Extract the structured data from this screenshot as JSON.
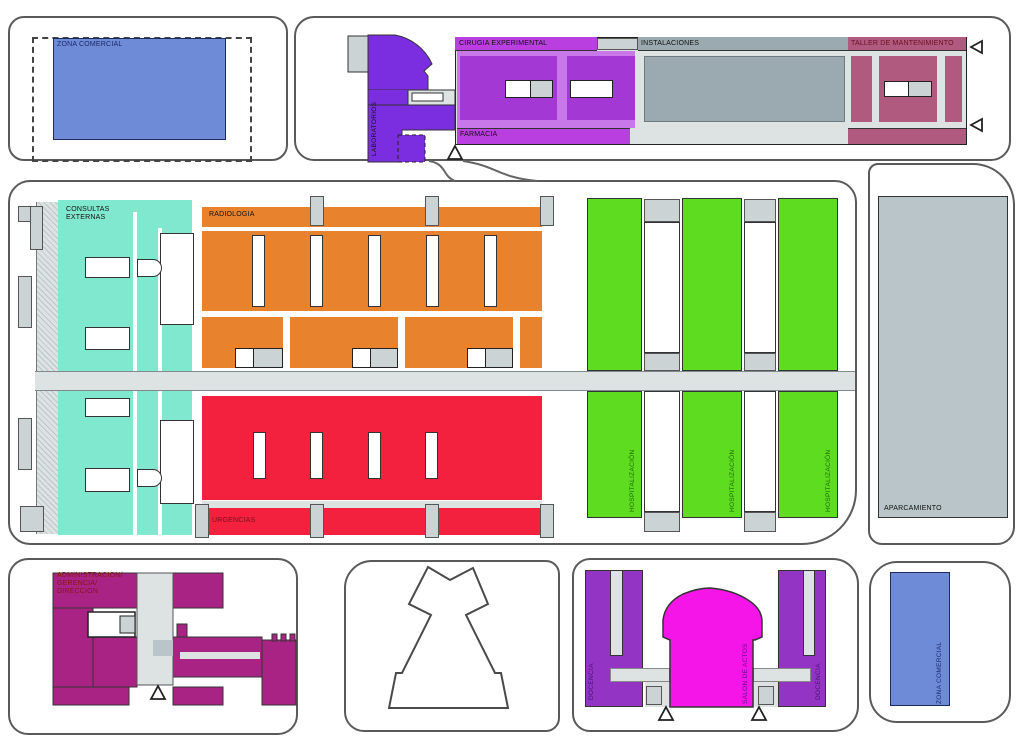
{
  "diagram": {
    "title": "hospital-zoning-floor-plan",
    "palette": {
      "blue": "#6e8bd8",
      "violet": "#7b2ee0",
      "bright_purple": "#b93fe0",
      "light_purple": "#c878e8",
      "dark_purple": "#a438d4",
      "gray_block": "#9baab0",
      "mauve": "#b05a80",
      "teal": "#80e8cf",
      "orange": "#e8822c",
      "red": "#f3203e",
      "green": "#5edc1f",
      "admin_magenta": "#a82384",
      "docencia_purple": "#9434c4",
      "salon_magenta": "#f515e8",
      "parking_gray": "#b9c5c8",
      "corridor_gray": "#dde2e2"
    },
    "zones": {
      "zona_comercial_top": {
        "label": "ZONA COMERCIAL",
        "color": "#6e8bd8"
      },
      "laboratorios": {
        "label": "LABORATORIOS",
        "color": "#7b2ee0"
      },
      "cirugia_experimental": {
        "label": "CIRUGIA EXPERIMENTAL",
        "color": "#b93fe0"
      },
      "farmacia": {
        "label": "FARMACIA",
        "color": "#b93fe0"
      },
      "instalaciones": {
        "label": "INSTALACIONES",
        "color": "#9baab0"
      },
      "taller_mantenimiento": {
        "label": "TALLER DE MANTENIMIENTO",
        "color": "#b05a80"
      },
      "consultas_externas": {
        "label_line1": "CONSULTAS",
        "label_line2": "EXTERNAS",
        "color": "#80e8cf"
      },
      "radiologia": {
        "label": "RADIOLOGIA",
        "color": "#e8822c"
      },
      "urgencias": {
        "label": "URGENCIAS",
        "color": "#f3203e"
      },
      "hospitalizacion": {
        "label": "HOSPITALIZACIÓN",
        "color": "#5edc1f",
        "count": 3
      },
      "aparcamiento": {
        "label": "APARCAMIENTO",
        "color": "#b9c5c8"
      },
      "administracion": {
        "label_line1": "ADMINISTRACION/",
        "label_line2": "GERENCIA/",
        "label_line3": "DIRECCION",
        "color": "#a82384"
      },
      "docencia": {
        "label": "DOCENCIA",
        "color": "#9434c4",
        "count": 2
      },
      "salon_de_actos": {
        "label": "SALON DE ACTOS",
        "color": "#f515e8"
      },
      "zona_comercial_bottom": {
        "label": "ZONA COMERCIAL",
        "color": "#6e8bd8"
      }
    }
  }
}
